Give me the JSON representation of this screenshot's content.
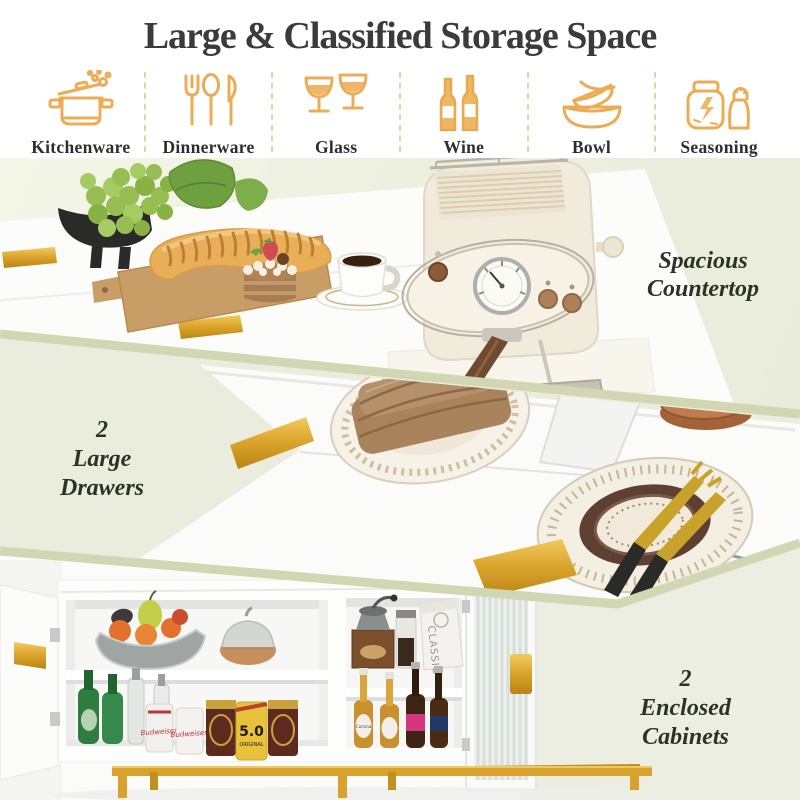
{
  "title": "Large & Classified Storage Space",
  "categories": [
    {
      "icon": "pot-icon",
      "label": "Kitchenware"
    },
    {
      "icon": "cutlery-icon",
      "label": "Dinnerware"
    },
    {
      "icon": "wine-glasses-icon",
      "label": "Glass"
    },
    {
      "icon": "wine-bottles-icon",
      "label": "Wine"
    },
    {
      "icon": "stacked-bowls-icon",
      "label": "Bowl"
    },
    {
      "icon": "jar-and-shaker-icon",
      "label": "Seasoning"
    }
  ],
  "features": {
    "countertop": {
      "lines": [
        "Spacious",
        "Countertop"
      ]
    },
    "drawers": {
      "lines": [
        "2",
        "Large",
        "Drawers"
      ]
    },
    "cabinets": {
      "lines": [
        "2",
        "Enclosed",
        "Cabinets"
      ]
    }
  },
  "photo_text": {
    "yellow_can_number": "5.0",
    "yellow_can_word": "ORIGINAL",
    "white_can_brand": "Budweiser",
    "coffee_bag_brand": "CLASSIC",
    "beer_bottle_brand": "Corona"
  },
  "colors": {
    "icon_gold": "#ECAC55",
    "handle_gold": "#D9A32A",
    "separator_sage": "#D2D7B3",
    "band_sage_bg": "#EAECDD",
    "cream_bg": "#EDEEE2",
    "counter_bg": "#ECEEDE",
    "caption_text": "#2D3227",
    "title_text": "#3B3B3B"
  }
}
